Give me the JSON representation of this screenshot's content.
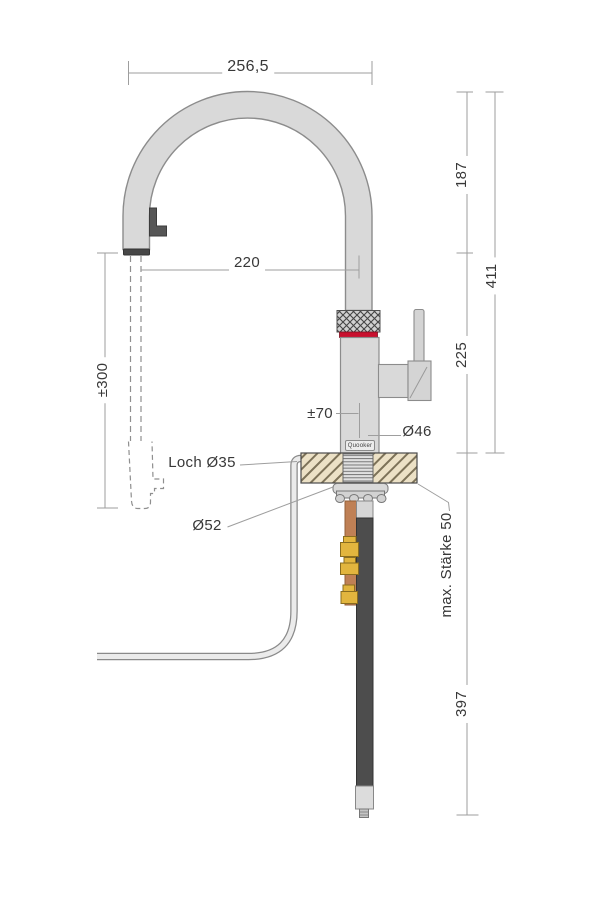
{
  "diagram": {
    "title": "Quooker tap technical drawing",
    "brand": "Quooker",
    "colors": {
      "faucet_gray": "#d9d9d9",
      "outline_gray": "#8c8c8c",
      "red_ring": "#c8102e",
      "countertop_beige": "#ece1c6",
      "copper": "#bf8055",
      "brass": "#e2b53e",
      "hose_dark": "#4d4d4d",
      "dimension_line": "#9e9e9e",
      "text": "#383838"
    },
    "labels": {
      "top_width": "256,5",
      "reach": "220",
      "hose_extension": "±300",
      "swivel": "±70",
      "body_diameter": "Ø46",
      "hole": "Loch Ø35",
      "flange": "Ø52",
      "max_thickness": "max. Stärke 50",
      "upper_segment": "187",
      "total_above": "411",
      "lower_segment": "225",
      "below_counter": "397"
    }
  }
}
